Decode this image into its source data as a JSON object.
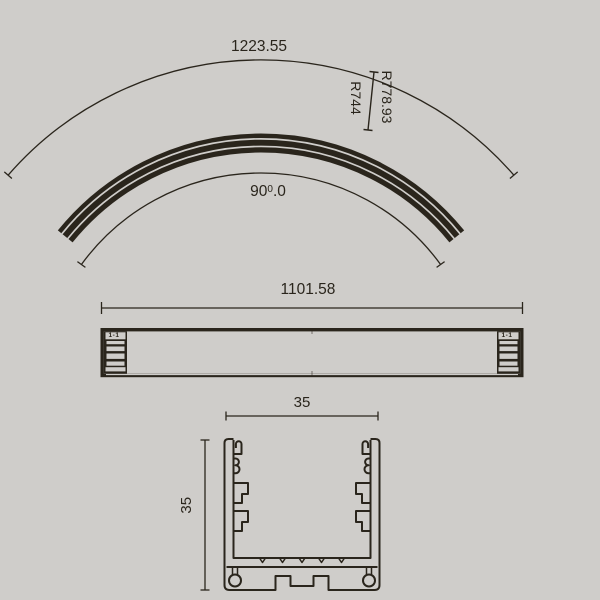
{
  "colors": {
    "background": "#cfcdca",
    "ink": "#2a251c"
  },
  "curved_view": {
    "arc_length_label": "1223.55",
    "radius_outer_label": "R778.93",
    "radius_inner_label": "R744",
    "angle_main": "90",
    "angle_sup": "0",
    "angle_dec": ".0"
  },
  "side_view": {
    "length_label": "1101.58",
    "section_mark_left": "1-1",
    "section_mark_right": "1-1"
  },
  "section_view": {
    "width_label": "35",
    "height_label": "35"
  }
}
